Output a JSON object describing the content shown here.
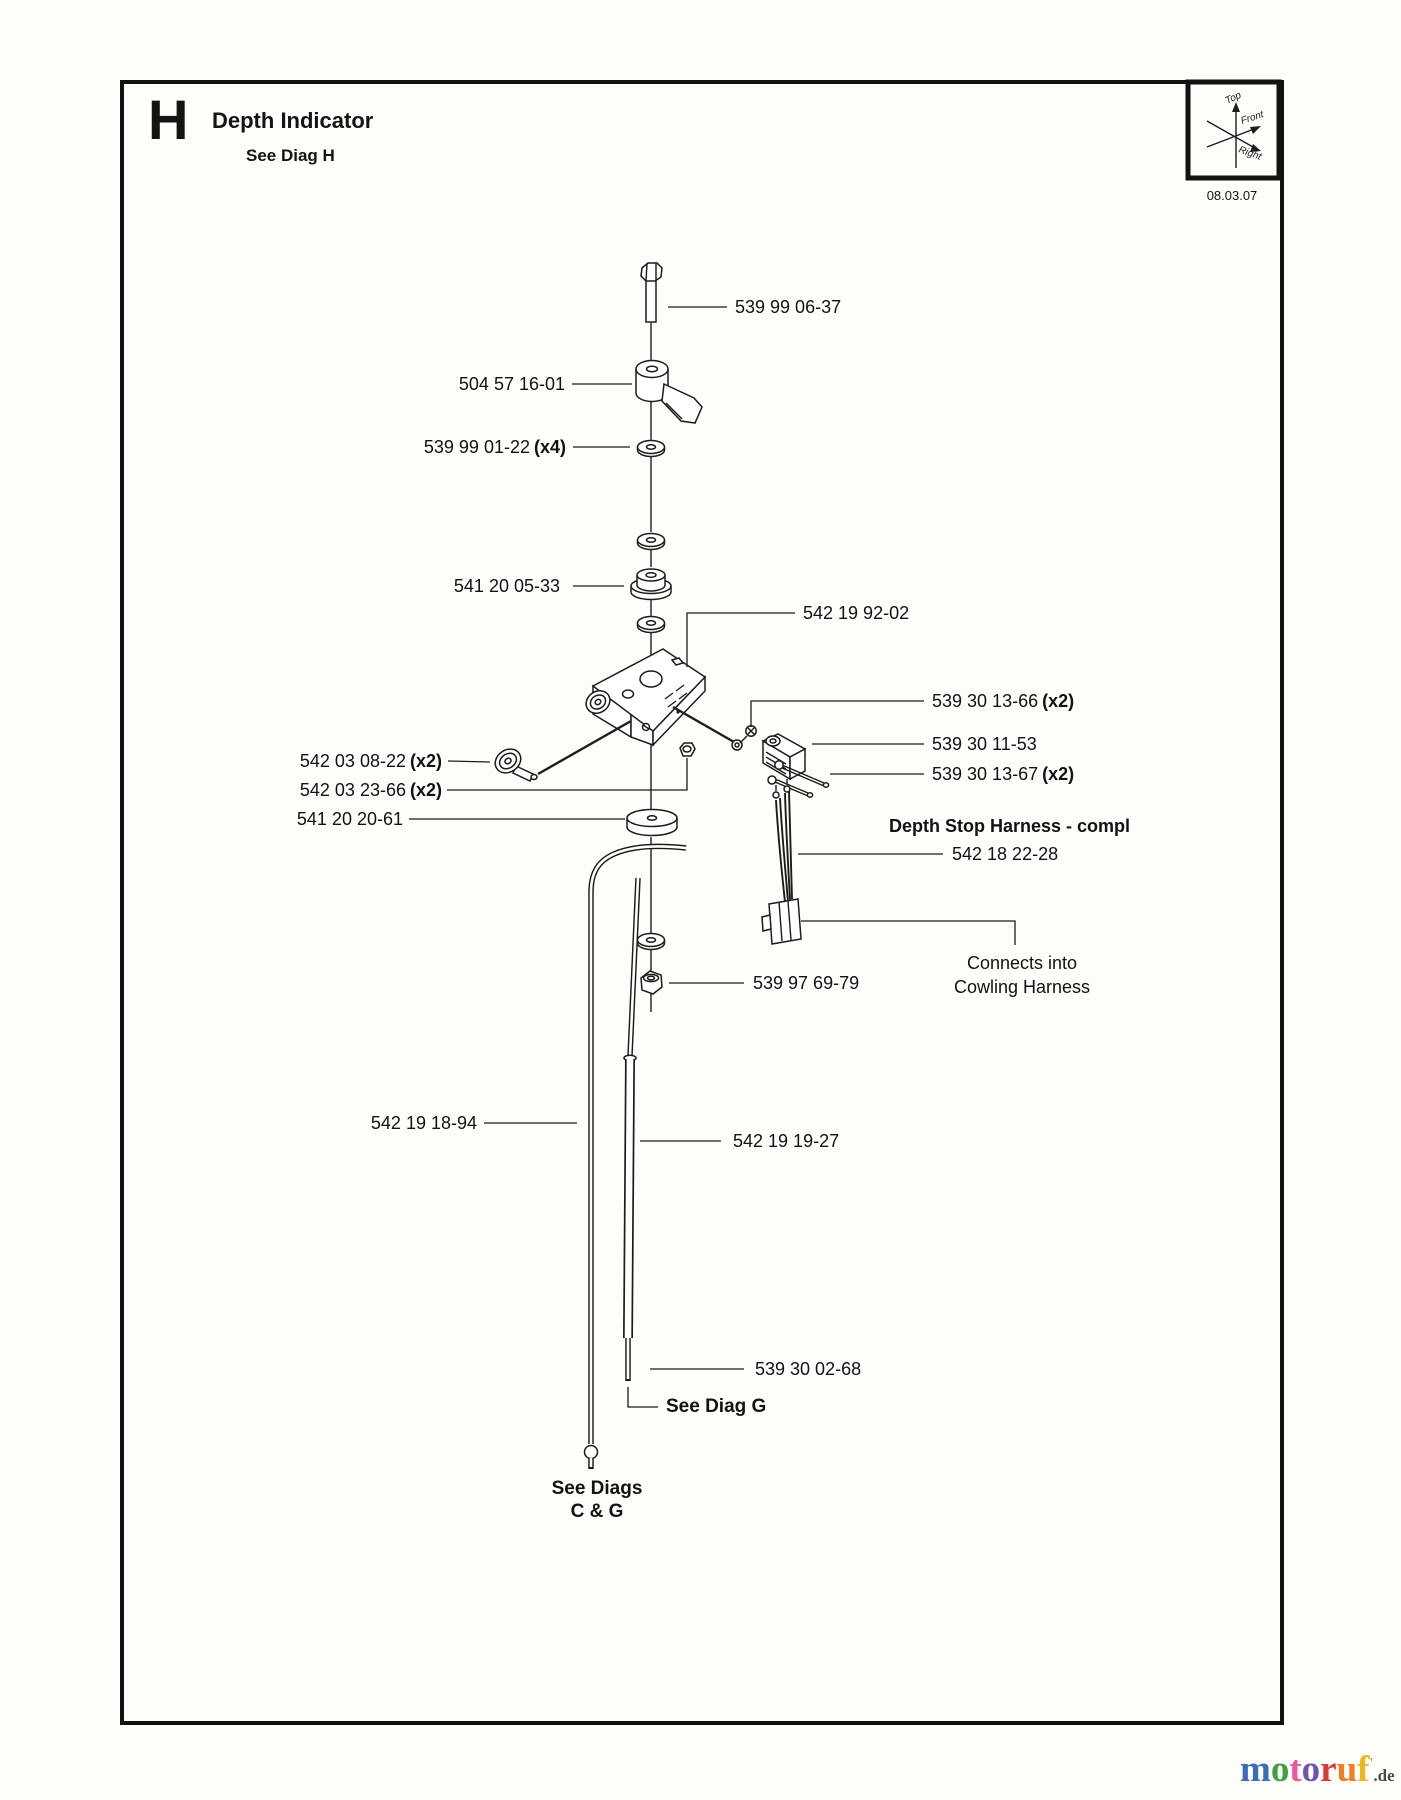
{
  "page": {
    "section_letter": "H",
    "title": "Depth Indicator",
    "subtitle": "See Diag H",
    "date": "08.03.07",
    "orientation": {
      "top": "Top",
      "front": "Front",
      "right": "Right"
    }
  },
  "part_labels": {
    "bolt": {
      "text": "539 99 06-37"
    },
    "lever": {
      "text": "504 57 16-01"
    },
    "washer": {
      "text": "539 99 01-22",
      "suffix": "(x4)"
    },
    "spacer": {
      "text": "541 20 05-33"
    },
    "bracket": {
      "text": "542 19 92-02"
    },
    "screw_upper": {
      "text": "539 30 13-66",
      "suffix": "(x2)"
    },
    "switch": {
      "text": "539 30 11-53"
    },
    "screw_lower": {
      "text": "539 30 13-67",
      "suffix": "(x2)"
    },
    "roller": {
      "text": "542 03 08-22",
      "suffix": "(x2)"
    },
    "nut_small": {
      "text": "542 03 23-66",
      "suffix": "(x2)"
    },
    "disc": {
      "text": "541 20 20-61"
    },
    "harness_title": {
      "text": "Depth Stop Harness - compl"
    },
    "harness": {
      "text": "542 18 22-28"
    },
    "connects_note_line1": "Connects into",
    "connects_note_line2": "Cowling Harness",
    "nut_lower": {
      "text": "539 97 69-79"
    },
    "cable": {
      "text": "542 19 18-94"
    },
    "rod": {
      "text": "542 19 19-27"
    },
    "rod_tip": {
      "text": "539 30 02-68"
    },
    "see_diag_g": {
      "text": "See Diag G"
    },
    "see_diags_line1": "See Diags",
    "see_diags_line2": "C & G"
  },
  "watermark": {
    "letters": [
      {
        "ch": "m",
        "color": "#3d6db5"
      },
      {
        "ch": "o",
        "color": "#3da23d"
      },
      {
        "ch": "t",
        "color": "#e8599e"
      },
      {
        "ch": "o",
        "color": "#6f55b0"
      },
      {
        "ch": "r",
        "color": "#d93838"
      },
      {
        "ch": "u",
        "color": "#ef7d2a"
      },
      {
        "ch": "f",
        "color": "#e5b91f"
      }
    ],
    "mark": "'",
    "domain": ".de"
  }
}
